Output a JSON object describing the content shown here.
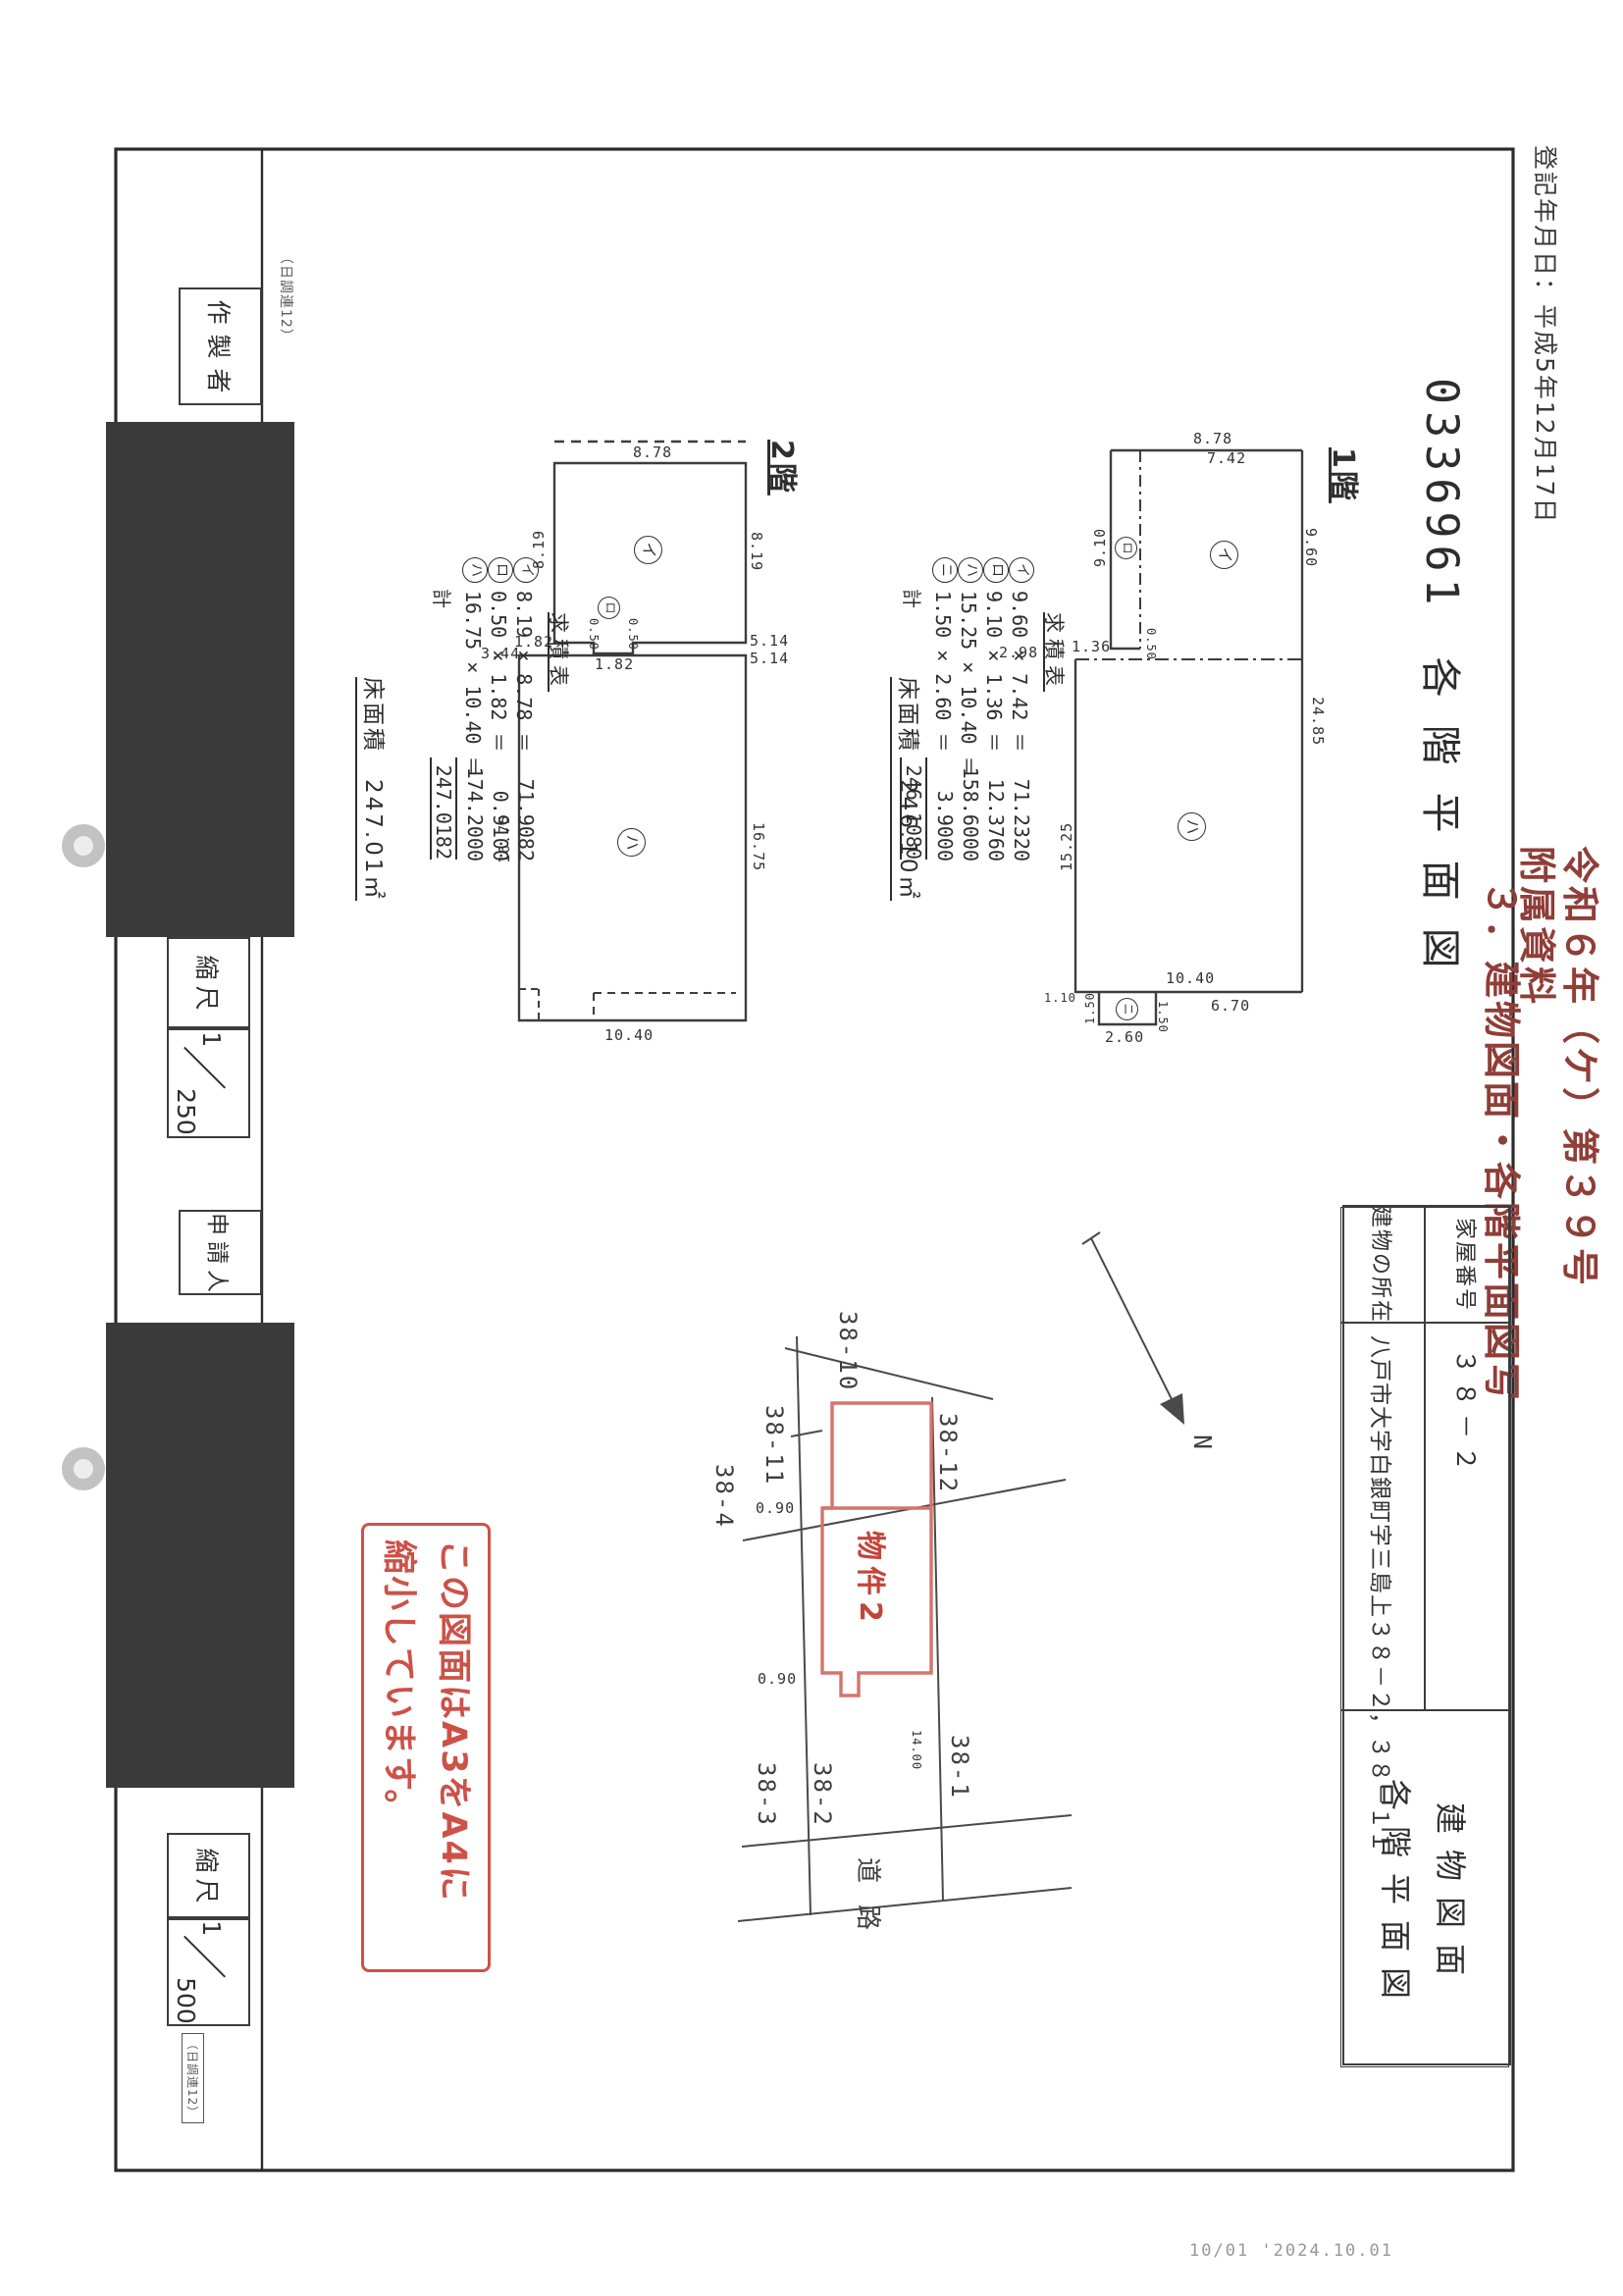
{
  "page": {
    "registration_date": "登記年月日：平成5年12月17日",
    "document_number": "0336961",
    "document_number_title": "各階平面図",
    "case_stamp_line1": "令和６年（ケ）第３９号",
    "case_stamp_line2": "附属資料",
    "case_stamp_line3": "３．建物図面・各階平面図写",
    "reduction_stamp_line1": "この図面はA3をA4に",
    "reduction_stamp_line2": "縮小しています。",
    "form_mark_top": "（日調連12）",
    "form_mark_bottom": "（日調連12）",
    "footer_stamp": "10/01 '2024.10.01",
    "colors": {
      "case_red": "#8f3e38",
      "stamp_red": "#cc5248",
      "building_red": "#d3756b",
      "ink": "#3a3a3a"
    }
  },
  "title_block": {
    "title_line1": "建物図面",
    "title_line2": "各階平面図",
    "house_number_label": "家屋番号",
    "house_number_value": "３８－２",
    "location_label": "建物の所在",
    "location_value": "八戸市大字白銀町字三島上３８－２，３８－１１"
  },
  "form_strip": {
    "maker_label": "作製者",
    "applicant_label": "申請人",
    "scale_label_1": "縮尺",
    "scale_label_2": "縮尺",
    "scale_floor_plan": {
      "numerator": "1",
      "denominator": "250"
    },
    "scale_site_plan": {
      "numerator": "1",
      "denominator": "500"
    }
  },
  "floor2": {
    "label": "2階",
    "dims": {
      "top": "8.78",
      "side_left": "8.19",
      "side_right": "8.19",
      "jut_left": "1.82",
      "jut_width": "1.82",
      "jut_depth_left": "0.50",
      "jut_depth_right": "0.50",
      "step": "3.44",
      "seam_upper": "5.14",
      "seam_lower": "5.14",
      "lower_left": "16.75",
      "lower_right": "16.75",
      "bottom": "10.40"
    },
    "area_table": {
      "title": "求積表",
      "rows": [
        {
          "mark": "イ",
          "expr": "8.19 × 8.78 ＝",
          "value": "71.9082"
        },
        {
          "mark": "ロ",
          "expr": "0.50 × 1.82 ＝",
          "value": "0.9100"
        },
        {
          "mark": "ハ",
          "expr": "16.75 × 10.40 ＝",
          "value": "174.2000"
        }
      ],
      "total_label": "計",
      "total_value": "247.0182"
    },
    "floor_area_label": "床面積",
    "floor_area_value": "247.01㎡"
  },
  "floor1": {
    "label": "1階",
    "dims": {
      "top": "8.78",
      "top_inner": "7.42",
      "left": "9.10",
      "right": "9.60",
      "wing_bottom": "1.36",
      "wing_gap": "0.50",
      "offset": "2.98",
      "lower_left": "15.25",
      "right_total": "24.85",
      "bottom": "10.40",
      "bottom_right": "6.70",
      "porch_offset": "1.10",
      "porch_width": "2.60",
      "porch_depth_left": "1.50",
      "porch_depth_right": "1.50"
    },
    "area_table": {
      "title": "求積表",
      "rows": [
        {
          "mark": "イ",
          "expr": "9.60 × 7.42 ＝",
          "value": "71.2320"
        },
        {
          "mark": "ロ",
          "expr": "9.10 × 1.36 ＝",
          "value": "12.3760"
        },
        {
          "mark": "ハ",
          "expr": "15.25 × 10.40 ＝",
          "value": "158.6000"
        },
        {
          "mark": "ニ",
          "expr": "1.50 × 2.60 ＝",
          "value": "3.9000"
        }
      ],
      "total_label": "計",
      "total_value": "246.1080"
    },
    "floor_area_label": "床面積",
    "floor_area_value": "246.10㎡"
  },
  "site_plan": {
    "parcel_top": "38-10",
    "parcel_left": "38-11",
    "parcel_far_left": "38-4",
    "parcel_right": "38-12",
    "parcel_bottom_left": "38-3",
    "parcel_center": "38-2",
    "parcel_bottom_right": "38-1",
    "building_label": "物件2",
    "road_label": "道路",
    "dim_upper": "0.90",
    "dim_lower": "0.90",
    "dim_side": "14.00",
    "north_label": "N"
  }
}
